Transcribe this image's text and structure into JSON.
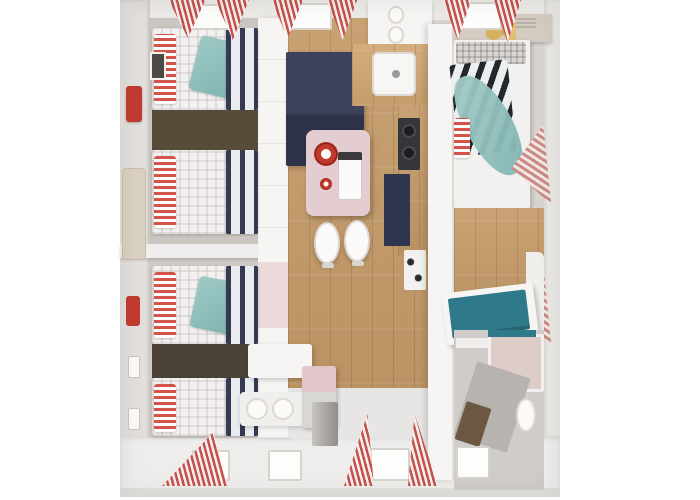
{
  "scene": {
    "type": "3d-floorplan-top-view",
    "description": "Photorealistic top-down 3D render of a small holiday home interior with two kids bedrooms on the left, an open-plan living and kitchen area in the center, and a master bedroom with bench seat and bathroom on the right"
  },
  "palette": {
    "page-bg": "#ffffff",
    "wall-light": "#eceae7",
    "wall-mid": "#ddd9d5",
    "wall-side": "#e2dfdc",
    "bedroom-floor": "#ccc6c0",
    "bedroom-floor-2": "#d1cbc5",
    "wood": "#c49a68",
    "wood-light": "#cfa672",
    "navy": "#343a52",
    "navy-dark": "#2e3349",
    "teal": "#8fc0bd",
    "teal-dark": "#2f7a8a",
    "red": "#c23b30",
    "pink": "#e3cdd0",
    "bed-white": "#f3f1ef",
    "furn-white": "#f6f5f3",
    "curtain-red": "#c5524c",
    "curtain-pink": "#c98b85",
    "dark-gap": "#564c39",
    "bath-gray": "#cfccc9",
    "stove": "#35363a"
  },
  "rooms": [
    {
      "id": "kids-bedroom-1",
      "label": "kids bedroom top-left",
      "furniture": [
        "single-bed-with-teal-blanket",
        "single-bed",
        "red-striped-pillows",
        "navy-striped-runners",
        "nightstand-gap",
        "picture-frame",
        "red-wall-lamp",
        "window-with-striped-curtains"
      ]
    },
    {
      "id": "kids-bedroom-2",
      "label": "kids bedroom bottom-left",
      "furniture": [
        "single-bed-with-teal-blanket",
        "single-bed",
        "red-striped-pillows",
        "navy-striped-runners",
        "red-wall-lamp",
        "entry-door",
        "wall-outlets",
        "window-with-striped-curtains"
      ]
    },
    {
      "id": "living-kitchen",
      "label": "open-plan living and kitchen center",
      "furniture": [
        "navy-sofa",
        "kitchen-upper-cabinet",
        "double-basin-sink",
        "wood-worktop",
        "hob-two-burners",
        "navy-base-cabinet",
        "dining-table",
        "red-plates",
        "napkin-box",
        "two-oval-chairs",
        "vanity-desk",
        "pink-bench",
        "mirror-box",
        "windows-with-striped-curtains"
      ]
    },
    {
      "id": "master-bedroom",
      "label": "master bedroom top-right",
      "furniture": [
        "double-bed-striped-duvet",
        "teal-throw",
        "checked-pillow",
        "red-striped-pillow",
        "headboard-shelf",
        "gold-decor",
        "air-vents",
        "pink-bunched-curtains",
        "bench-with-teal-cushion"
      ]
    },
    {
      "id": "bathroom",
      "label": "bathroom bottom-right",
      "furniture": [
        "shower-door",
        "door-knob",
        "pink-cabinet",
        "floor-mat",
        "window"
      ]
    }
  ]
}
